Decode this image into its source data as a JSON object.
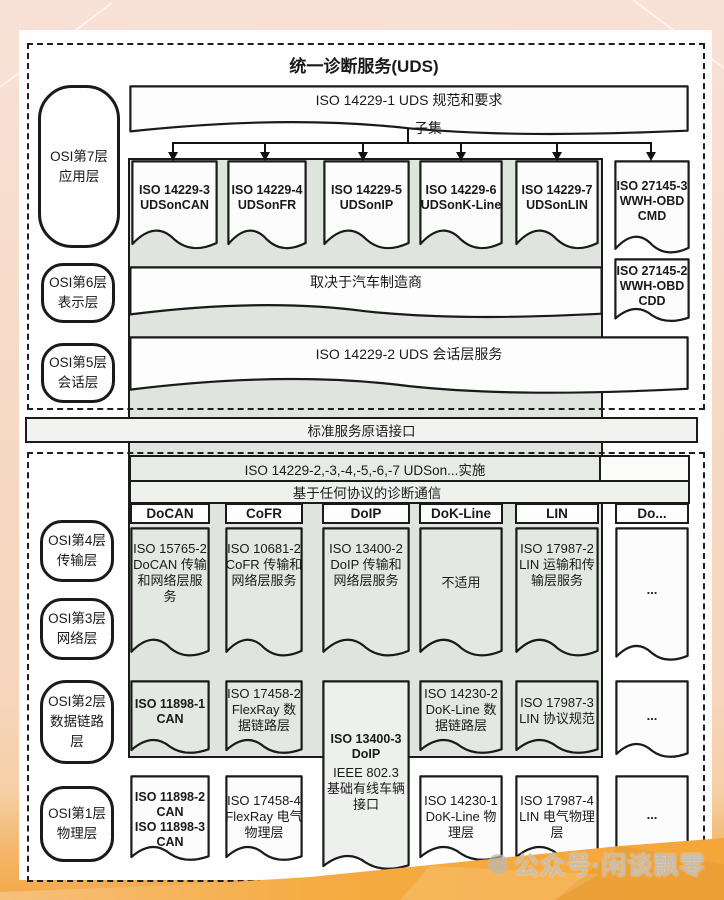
{
  "title": "统一诊断服务(UDS)",
  "watermark": {
    "text": "公众号·闲谈飘零"
  },
  "colors": {
    "panel_gray": "#dfe4df",
    "cell_gray": "#e3e8e3",
    "box_white": "#fcfcfc",
    "border_black": "#1a1a1a",
    "band_orange": "#f5a63a",
    "frame_pink": "#f7dccb"
  },
  "osi_labels": [
    {
      "lines": [
        "OSI第7层",
        "应用层"
      ]
    },
    {
      "lines": [
        "OSI第6层",
        "表示层"
      ]
    },
    {
      "lines": [
        "OSI第5层",
        "会话层"
      ]
    },
    {
      "lines": [
        "OSI第4层",
        "传输层"
      ]
    },
    {
      "lines": [
        "OSI第3层",
        "网络层"
      ]
    },
    {
      "lines": [
        "OSI第2层",
        "数据链路",
        "层"
      ]
    },
    {
      "lines": [
        "OSI第1层",
        "物理层"
      ]
    }
  ],
  "top_section": {
    "spec_box": "ISO 14229-1 UDS 规范和要求",
    "subset_label": "子集",
    "app_boxes": [
      {
        "lines": [
          "ISO 14229-3",
          "UDSonCAN"
        ]
      },
      {
        "lines": [
          "ISO 14229-4",
          "UDSonFR"
        ]
      },
      {
        "lines": [
          "ISO 14229-5",
          "UDSonIP"
        ]
      },
      {
        "lines": [
          "ISO 14229-6",
          "UDSonK-Line"
        ]
      },
      {
        "lines": [
          "ISO 14229-7",
          "UDSonLIN"
        ]
      }
    ],
    "wwh_cmd": {
      "lines": [
        "ISO 27145-3",
        "WWH-OBD",
        "CMD"
      ]
    },
    "presentation_box": "取决于汽车制造商",
    "wwh_cdd": {
      "lines": [
        "ISO 27145-2",
        "WWH-OBD",
        "CDD"
      ]
    },
    "session_box": "ISO 14229-2 UDS 会话层服务"
  },
  "interface_bar": "标准服务原语接口",
  "bottom_section": {
    "impl_bar": "ISO 14229-2,-3,-4,-5,-6,-7 UDSon...实施",
    "protocol_bar": "基于任何协议的诊断通信",
    "column_headers": [
      "DoCAN",
      "CoFR",
      "DoIP",
      "DoK-Line",
      "LIN",
      "Do..."
    ],
    "transport_cells": [
      {
        "lines": [
          "ISO 15765-2",
          "DoCAN 传输",
          "和网络层服",
          "务"
        ]
      },
      {
        "lines": [
          "ISO 10681-2",
          "CoFR 传输和",
          "网络层服务"
        ]
      },
      {
        "lines": [
          "ISO 13400-2",
          "DoIP 传输和",
          "网络层服务"
        ]
      },
      {
        "lines": [
          "不适用"
        ]
      },
      {
        "lines": [
          "ISO 17987-2",
          "LIN 运输和传",
          "输层服务"
        ]
      },
      {
        "lines": [
          "..."
        ]
      }
    ],
    "datalink_cells": [
      {
        "lines": [
          "ISO 11898-1",
          "CAN"
        ]
      },
      {
        "lines": [
          "ISO 17458-2",
          "FlexRay 数",
          "据链路层"
        ]
      },
      {
        "lines": [
          "ISO 14230-2",
          "DoK-Line 数",
          "据链路层"
        ]
      },
      {
        "lines": [
          "ISO 17987-3",
          "LIN 协议规范"
        ]
      },
      {
        "lines": [
          "..."
        ]
      }
    ],
    "doip_box": {
      "bold_lines": [
        "ISO 13400-3",
        "DoIP"
      ],
      "lines": [
        "IEEE 802.3",
        "基础有线车辆",
        "接口"
      ]
    },
    "physical_cells": [
      {
        "lines": [
          "ISO 11898-2",
          "CAN",
          "ISO 11898-3",
          "CAN"
        ]
      },
      {
        "lines": [
          "ISO 17458-4",
          "FlexRay 电气",
          "物理层"
        ]
      },
      {
        "lines": [
          "ISO 14230-1",
          "DoK-Line 物",
          "理层"
        ]
      },
      {
        "lines": [
          "ISO 17987-4",
          "LIN 电气物理",
          "层"
        ]
      },
      {
        "lines": [
          "..."
        ]
      }
    ]
  }
}
